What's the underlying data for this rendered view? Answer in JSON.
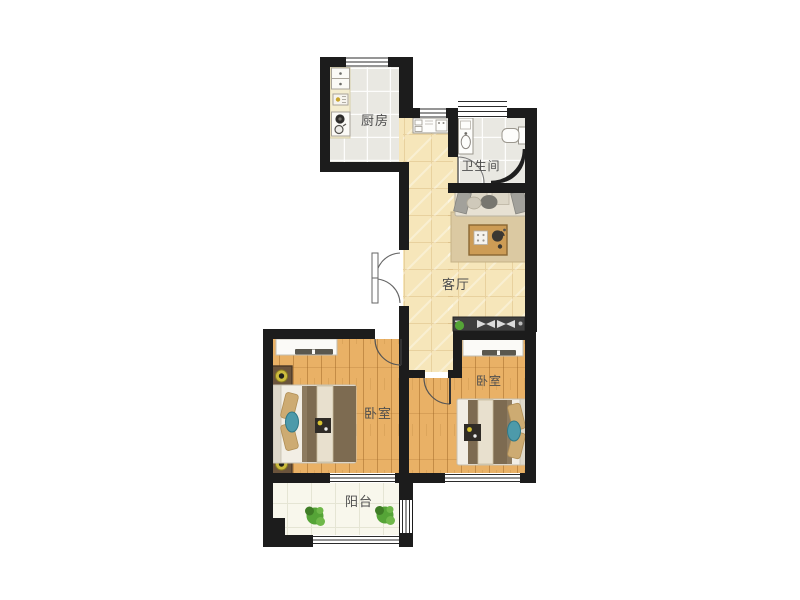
{
  "floorplan": {
    "rooms": [
      {
        "id": "kitchen",
        "label": "厨房"
      },
      {
        "id": "bathroom",
        "label": "卫生间"
      },
      {
        "id": "living-room",
        "label": "客厅"
      },
      {
        "id": "bedroom-left",
        "label": "卧室"
      },
      {
        "id": "bedroom-right",
        "label": "卧室"
      },
      {
        "id": "balcony",
        "label": "阳台"
      }
    ],
    "furniture": [
      "bed",
      "nightstand",
      "lamp",
      "wardrobe",
      "sofa",
      "coffee-table",
      "rug",
      "toilet",
      "vanity-sink",
      "shower-screen",
      "kitchen-counter",
      "stove",
      "sink",
      "washer-counter",
      "entrance-cabinet",
      "plant"
    ],
    "colors": {
      "wall": "#1c1c1c",
      "wood_floor": "#e9b166",
      "living_floor": "#f6e6ba",
      "tile_floor": "#e9e8e2",
      "balcony_floor": "#f8f7ec",
      "counter": "#f4edd0",
      "rug": "#dbc9a2",
      "blanket_brown": "#7d6b51",
      "accent_teal": "#4d9aaa",
      "plant_green": "#55a437",
      "lamp_yellow": "#cdbc3e",
      "table_wood": "#cd9c55"
    }
  }
}
